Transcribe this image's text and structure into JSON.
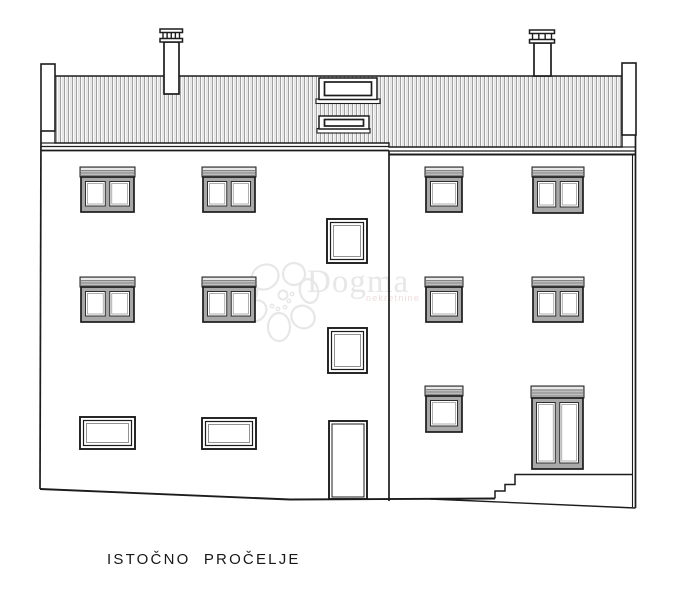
{
  "title": {
    "label": "ISTOČNO PROČELJE"
  },
  "watermark": {
    "brand": "Dogma",
    "subtext": "nekretnine",
    "color": "#e7e7e7",
    "subtext_color": "#eedcdc"
  },
  "colors": {
    "line": "#1c1c1c",
    "roof_stripe": "#8f8f8f",
    "roof_stripe_light": "#e2e2e2",
    "shutter_box": "#bfbfbf",
    "shutter_line": "#858585",
    "shutter_top": "#e8e8e8",
    "frame": "#a8a8a8",
    "pane_edge": "#2e2e2e",
    "pane_line": "#9a9a9a",
    "background": "#ffffff"
  },
  "drawing": {
    "canvas": {
      "w": 681,
      "h": 598
    },
    "roof": {
      "points": [
        [
          55,
          76
        ],
        [
          622,
          76
        ],
        [
          622,
          147
        ],
        [
          389,
          147
        ],
        [
          389,
          143
        ],
        [
          55,
          143
        ]
      ]
    },
    "parapets": [
      {
        "n": "left-parapet",
        "x": 41,
        "y": 64,
        "w": 14,
        "h": 67
      },
      {
        "n": "right-parapet",
        "x": 622,
        "y": 63,
        "w": 14,
        "h": 72
      }
    ],
    "chimneys": [
      {
        "n": "chimney-left",
        "stack": [
          164,
          42,
          15,
          52
        ],
        "plate1": [
          160,
          29,
          22.5,
          3.5
        ],
        "plate2": [
          160,
          38.5,
          22.5,
          3.5
        ],
        "posts": 3
      },
      {
        "n": "chimney-right",
        "stack": [
          534,
          43,
          17,
          33
        ],
        "plate1": [
          529.5,
          30,
          25,
          3.5
        ],
        "plate2": [
          529.5,
          39.5,
          25,
          3.5
        ],
        "posts": 2
      }
    ],
    "skylights": [
      {
        "sill": [
          316,
          99,
          64,
          4.5
        ],
        "outer": [
          319,
          78,
          58,
          21.5
        ],
        "inner": [
          324.5,
          82,
          47,
          13.5
        ]
      },
      {
        "sill": [
          317,
          128.5,
          53,
          4.5
        ],
        "outer": [
          319,
          116,
          50,
          13
        ],
        "inner": [
          324.5,
          119.5,
          39,
          6.5
        ]
      }
    ],
    "lines": [
      {
        "n": "left-eave-line",
        "p": [
          41,
          143,
          55,
          143
        ],
        "w": 1.2
      },
      {
        "n": "left-eave-line",
        "p": [
          41,
          146.5,
          389,
          146.5
        ],
        "w": 1.2
      },
      {
        "n": "left-facade-top",
        "p": [
          41,
          150.5,
          389,
          150.5
        ],
        "w": 1.8
      },
      {
        "n": "right-eave-line",
        "p": [
          622,
          147,
          635.5,
          147
        ],
        "w": 1.1
      },
      {
        "n": "right-eave-line",
        "p": [
          389,
          151,
          635.5,
          151
        ],
        "w": 1.3
      },
      {
        "n": "right-facade-top",
        "p": [
          389,
          154.5,
          635.5,
          154.5
        ],
        "w": 1.9
      },
      {
        "n": "section-joint-wall",
        "p": [
          389,
          150.5,
          389,
          501
        ],
        "w": 1.7
      },
      {
        "n": "right-wall-inner",
        "p": [
          632.5,
          154.5,
          632.5,
          507
        ],
        "w": 1.1
      },
      {
        "n": "right-wall-outer",
        "p": [
          635.5,
          135,
          635.5,
          508
        ],
        "w": 1.7
      }
    ],
    "polylines": [
      {
        "n": "left-wall",
        "p": [
          [
            41,
            131
          ],
          [
            40,
            489
          ]
        ],
        "w": 1.7
      },
      {
        "n": "ground-line",
        "p": [
          [
            40,
            489
          ],
          [
            290,
            499.5
          ],
          [
            495,
            498.5
          ]
        ],
        "w": 1.9
      },
      {
        "n": "terrain-slope",
        "p": [
          [
            430,
            499
          ],
          [
            635.5,
            508
          ]
        ],
        "w": 1.4
      },
      {
        "n": "entrance-steps",
        "p": [
          [
            495,
            498.5
          ],
          [
            495,
            491
          ],
          [
            505,
            491
          ],
          [
            505,
            484.5
          ],
          [
            515,
            484.5
          ],
          [
            515,
            474.5
          ],
          [
            632.5,
            474.5
          ]
        ],
        "w": 1.5
      }
    ],
    "windows": [
      {
        "n": "window-shutter-double",
        "x": 80,
        "y": 167,
        "w": 55,
        "h": 46,
        "t": "shutter",
        "panes": 2
      },
      {
        "n": "window-shutter-double",
        "x": 202,
        "y": 167,
        "w": 54,
        "h": 46,
        "t": "shutter",
        "panes": 2
      },
      {
        "n": "window-shutter-double",
        "x": 80,
        "y": 277,
        "w": 55,
        "h": 46,
        "t": "shutter",
        "panes": 2
      },
      {
        "n": "window-shutter-double",
        "x": 202,
        "y": 277,
        "w": 54,
        "h": 46,
        "t": "shutter",
        "panes": 2
      },
      {
        "n": "window-shutter-single",
        "x": 425,
        "y": 167,
        "w": 38,
        "h": 46,
        "t": "shutter",
        "panes": 1
      },
      {
        "n": "window-shutter-double",
        "x": 532,
        "y": 167,
        "w": 52,
        "h": 47,
        "t": "shutter",
        "panes": 2
      },
      {
        "n": "window-shutter-single",
        "x": 425,
        "y": 277,
        "w": 38,
        "h": 46,
        "t": "shutter",
        "panes": 1
      },
      {
        "n": "window-shutter-double",
        "x": 532,
        "y": 277,
        "w": 52,
        "h": 46,
        "t": "shutter",
        "panes": 2
      },
      {
        "n": "window-shutter-single",
        "x": 425,
        "y": 386,
        "w": 38,
        "h": 47,
        "t": "shutter",
        "panes": 1
      },
      {
        "n": "balcony-door",
        "x": 531,
        "y": 386,
        "w": 53,
        "h": 84,
        "t": "shutter",
        "panes": 2,
        "bh": 12
      },
      {
        "n": "stairwell-window",
        "x": 327,
        "y": 219,
        "w": 40,
        "h": 44,
        "t": "plain"
      },
      {
        "n": "stairwell-window",
        "x": 328,
        "y": 328,
        "w": 39,
        "h": 45,
        "t": "plain"
      },
      {
        "n": "basement-window",
        "x": 80,
        "y": 417,
        "w": 55,
        "h": 32,
        "t": "plain"
      },
      {
        "n": "basement-window",
        "x": 202,
        "y": 418,
        "w": 54,
        "h": 31,
        "t": "plain"
      }
    ],
    "door": {
      "n": "entry-door",
      "x": 329,
      "y": 421,
      "w": 38,
      "h": 78
    },
    "watermark_logo": {
      "cx": 281,
      "cy": 297,
      "r_center": 4.5,
      "petals": [
        [
          -16,
          -20,
          14,
          12,
          -30
        ],
        [
          13,
          -23,
          11,
          11,
          25
        ],
        [
          28,
          -6,
          12,
          9,
          75
        ],
        [
          22,
          20,
          12,
          11,
          35
        ],
        [
          -2,
          30,
          11,
          14,
          0
        ],
        [
          -26,
          14,
          12,
          10,
          -35
        ],
        [
          -33,
          -5,
          9,
          12,
          10
        ]
      ],
      "dots": [
        [
          8,
          4
        ],
        [
          4,
          10
        ],
        [
          -3,
          12
        ],
        [
          11,
          -3
        ],
        [
          -9,
          9
        ]
      ],
      "brand_pos": [
        307,
        292
      ],
      "subtext_pos": [
        366,
        301
      ]
    }
  }
}
